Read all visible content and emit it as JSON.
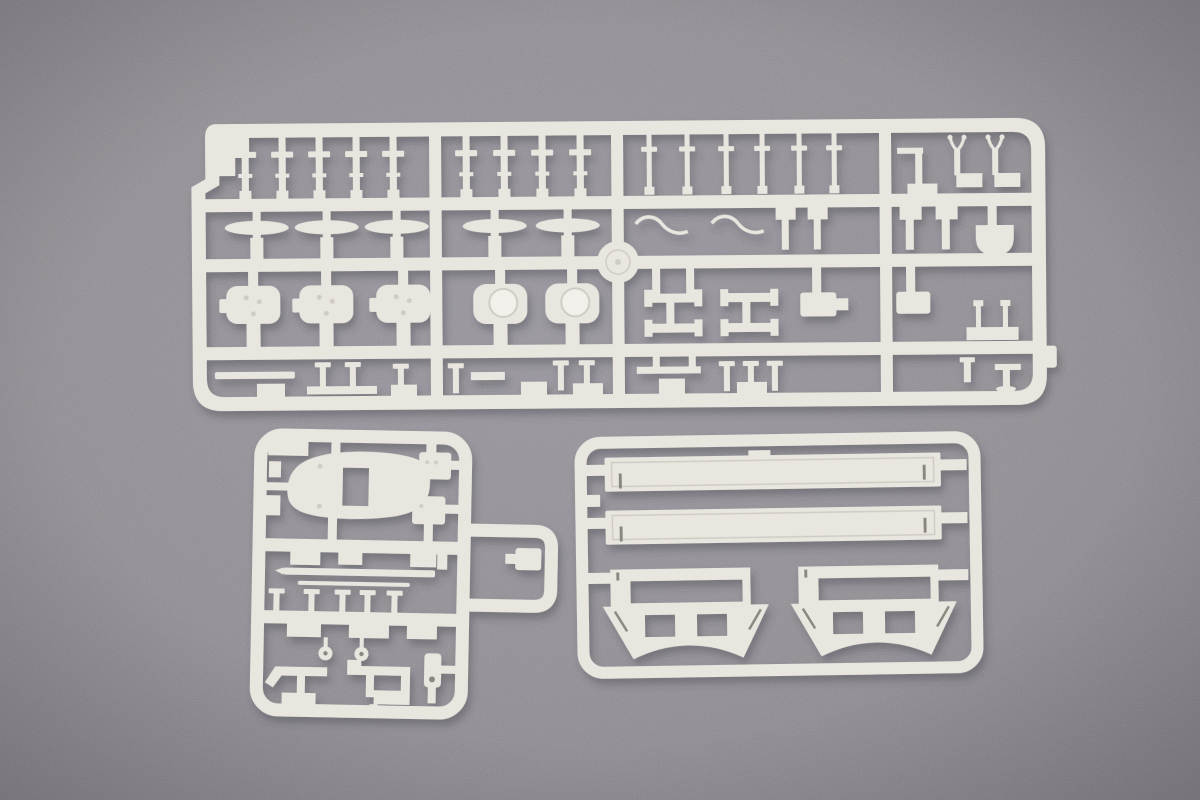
{
  "meta": {
    "alt": "Top-down photograph of three white injection-moulded plastic model kit sprues (runner frames holding small warship parts) lying on a mottled grey felt background"
  },
  "colors": {
    "bg_center": "#95929a",
    "bg_mid": "#8e8b91",
    "bg_edge": "#7f7c84",
    "plastic": "#e9e6df",
    "plastic_hi": "#f2f0ea",
    "detail": "#cfccc4",
    "slit": "#8a8780",
    "shadow": "#3c3a40"
  },
  "sprues": [
    {
      "id": "sprue-large",
      "position": "top",
      "description": "Large runner: rows of railing stanchions, mushroom ventilators, gun turret housings, davits, funnel and deck fittings"
    },
    {
      "id": "sprue-small",
      "position": "bottom-left",
      "description": "Small runner: superstructure platform, director brackets, thin rods, stanchions, ring bollards and deck fittings with an external runner loop"
    },
    {
      "id": "sprue-hull",
      "position": "bottom-right",
      "description": "Hull runner: two long deck planks and two arched stand cradles"
    }
  ]
}
